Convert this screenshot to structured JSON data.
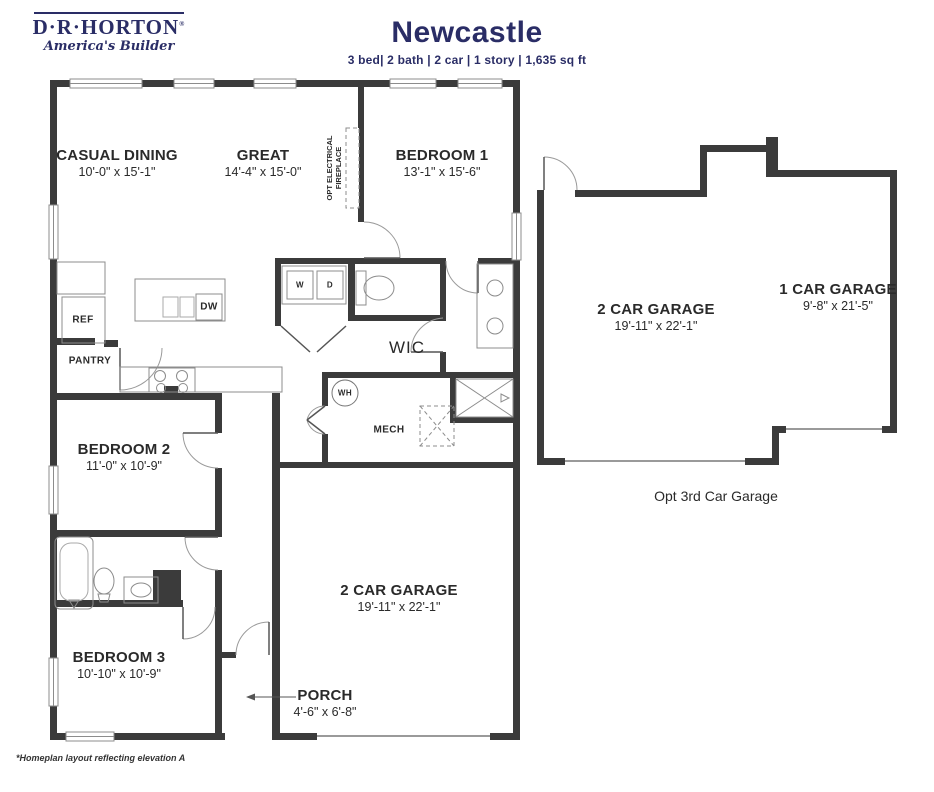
{
  "header": {
    "logo": {
      "brand": "D·R·HORTON",
      "registered": "®",
      "tagline": "America's Builder"
    },
    "title": "Newcastle",
    "specs": "3 bed| 2 bath | 2 car | 1 story | 1,635 sq ft"
  },
  "rooms": {
    "casual_dining": {
      "label": "CASUAL DINING",
      "dims": "10'-0\" x 15'-1\""
    },
    "great": {
      "label": "GREAT",
      "dims": "14'-4\" x 15'-0\""
    },
    "bedroom1": {
      "label": "BEDROOM 1",
      "dims": "13'-1\" x 15'-6\""
    },
    "bedroom2": {
      "label": "BEDROOM 2",
      "dims": "11'-0\" x 10'-9\""
    },
    "bedroom3": {
      "label": "BEDROOM 3",
      "dims": "10'-10\" x 10'-9\""
    },
    "garage_main": {
      "label": "2 CAR GARAGE",
      "dims": "19'-11\" x 22'-1\""
    },
    "garage_opt_2car": {
      "label": "2 CAR GARAGE",
      "dims": "19'-11\" x 22'-1\""
    },
    "garage_opt_1car": {
      "label": "1 CAR GARAGE",
      "dims": "9'-8\" x 21'-5\""
    },
    "porch": {
      "label": "PORCH",
      "dims": "4'-6\" x 6'-8\""
    },
    "wic": {
      "label": "WIC"
    },
    "mech": {
      "label": "MECH"
    }
  },
  "fixtures": {
    "ref": "REF",
    "pantry": "PANTRY",
    "dw": "DW",
    "washer": "W",
    "dryer": "D",
    "water_heater": "WH",
    "fireplace": "OPT ELECTRICAL FIREPLACE"
  },
  "annotations": {
    "opt_garage": "Opt 3rd Car Garage",
    "footnote": "*Homeplan layout reflecting elevation A"
  },
  "colors": {
    "navy": "#2a2d66",
    "wall": "#3b3b3b",
    "fixture_line": "#8c8c8c"
  }
}
